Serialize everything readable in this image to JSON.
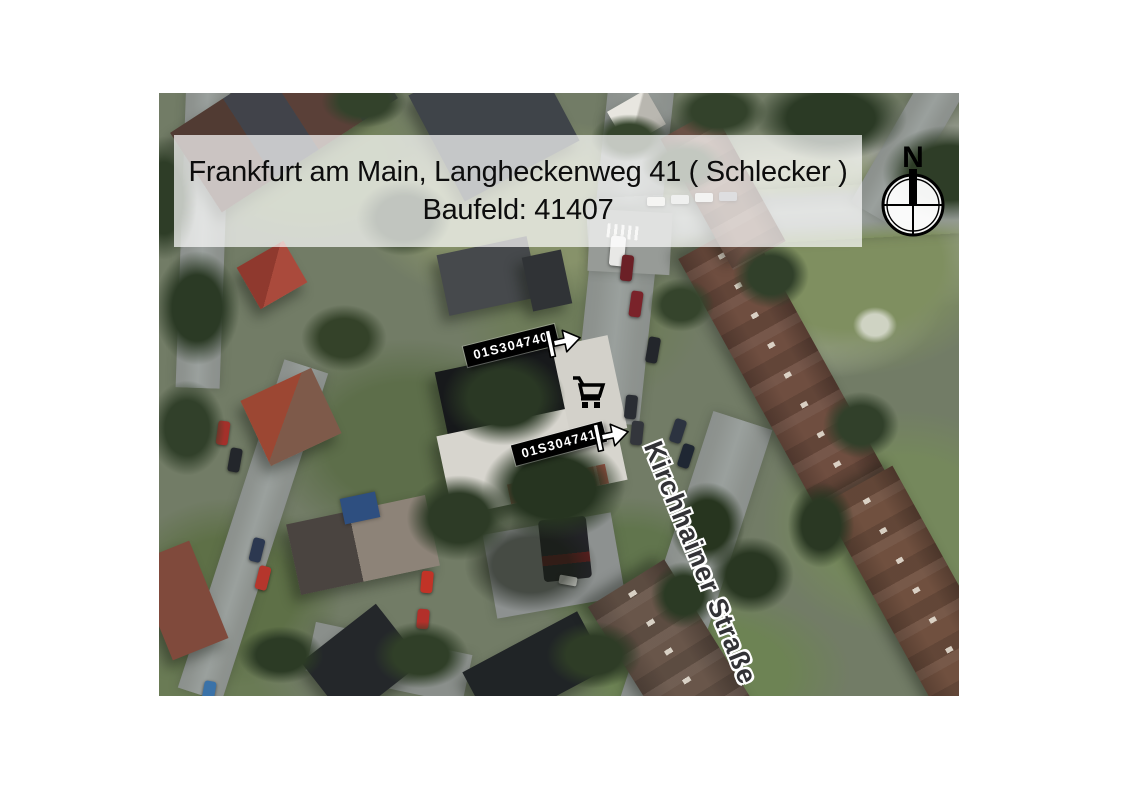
{
  "map": {
    "title_line1": "Frankfurt am Main, Langheckenweg 41 ( Schlecker )",
    "title_line2": "Baufeld: 41407",
    "street_label": "Kirchhainer Straße",
    "compass": {
      "north_label": "N"
    },
    "markers": [
      {
        "id": "01S304740"
      },
      {
        "id": "01S304741"
      }
    ],
    "icons": {
      "cart": "shopping-cart-icon",
      "entrance_arrow": "entrance-arrow-icon",
      "compass_rose": "compass-rose-icon"
    },
    "colors": {
      "marker_bg": "#000000",
      "marker_text": "#ffffff",
      "banner_bg": "rgba(255,255,255,0.70)",
      "street_text": "#323236",
      "roof_dark": "#17191b",
      "roof_light": "#d7d5ce",
      "roof_brown": "#6f4e40",
      "red_stripe": "#bf574c"
    }
  }
}
